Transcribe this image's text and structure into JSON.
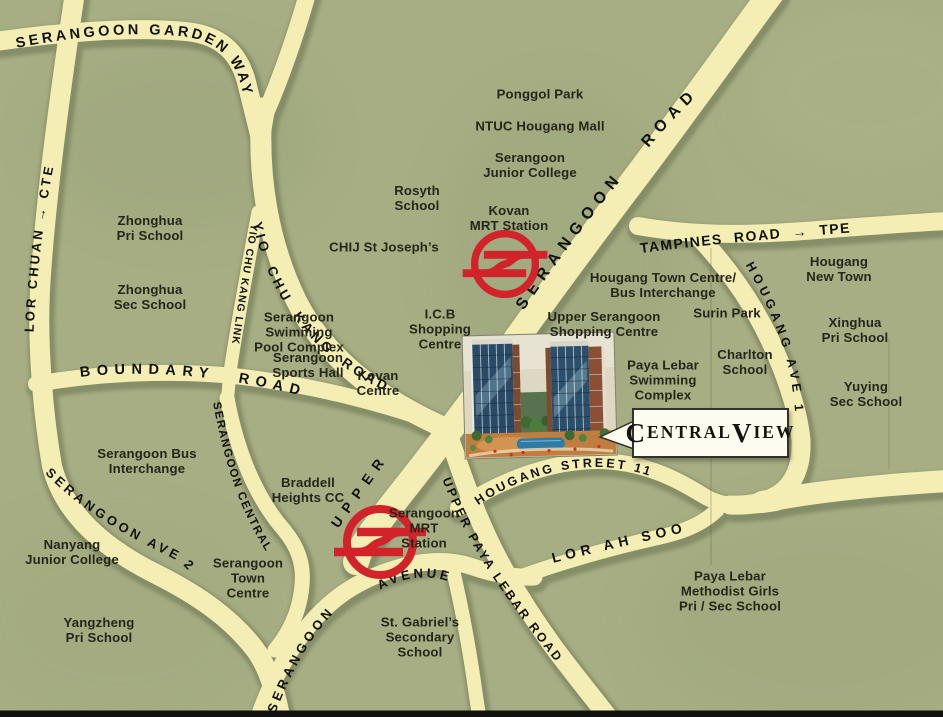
{
  "map": {
    "title": "Central View location map",
    "colors": {
      "background_green": "#a7ae84",
      "road_fill": "#f4eeb5",
      "road_shadow": "#6b7551",
      "label_text": "#26261a",
      "mrt_red": "#d2232b",
      "callout_background": "#fcfcf0",
      "callout_border": "#32322a"
    },
    "callout": {
      "label": "Central View",
      "parts": {
        "c1": "C",
        "r1": "ENTRAL",
        "c2": "V",
        "r2": "IEW"
      }
    },
    "roads": {
      "serangoon_garden_way": "SERANGOON GARDEN WAY",
      "lor_chuan": "LOR CHUAN → CTE",
      "yio_chu_kang_road": "YIO CHU KANG ROAD",
      "yio_chu_kang_link": "YIO CHU KANG LINK",
      "boundary_road": "BOUNDARY ROAD",
      "serangoon_road": "SERANGOON ROAD",
      "upper": "UPPER",
      "tampines_road": "TAMPINES ROAD → TPE",
      "hougang_ave_1": "HOUGANG AVE 1",
      "hougang_street_11": "HOUGANG STREET 11",
      "lor_ah_soo": "LOR AH SOO",
      "upper_paya_lebar_road": "UPPER PAYA LEBAR ROAD",
      "serangoon_central": "SERANGOON CENTRAL",
      "serangoon_ave_2": "SERANGOON AVE 2",
      "serangoon_avenue_a": "SERANGOON",
      "serangoon_avenue_b": "AVENUE"
    },
    "places": {
      "ponggol_park": "Ponggol Park",
      "ntuc_hougang_mall": "NTUC Hougang Mall",
      "serangoon_junior_college": "Serangoon\nJunior College",
      "rosyth_school": "Rosyth\nSchool",
      "kovan_mrt_station": "Kovan\nMRT Station",
      "chij_st_josephs": "CHIJ St Joseph’s",
      "zhonghua_pri_school": "Zhonghua\nPri School",
      "zhonghua_sec_school": "Zhonghua\nSec School",
      "hougang_town_centre": "Hougang Town Centre/\nBus Interchange",
      "hougang_new_town": "Hougang\nNew Town",
      "surin_park": "Surin Park",
      "xinghua_pri_school": "Xinghua\nPri School",
      "upper_serangoon_shopping_centre": "Upper Serangoon\nShopping Centre",
      "icb_shopping_centre": "I.C.B\nShopping\nCentre",
      "serangoon_swimming_pool": "Serangoon\nSwimming\nPool Complex",
      "serangoon_sports_hall": "Serangoon\nSports Hall",
      "kovan_centre": "Kovan\nCentre",
      "paya_lebar_swimming": "Paya Lebar\nSwimming\nComplex",
      "charlton_school": "Charlton\nSchool",
      "yuying_sec_school": "Yuying\nSec School",
      "serangoon_bus_interchange": "Serangoon Bus\nInterchange",
      "braddell_heights_cc": "Braddell\nHeights CC",
      "nanyang_junior_college": "Nanyang\nJunior College",
      "serangoon_town_centre": "Serangoon\nTown\nCentre",
      "yangzheng_pri_school": "Yangzheng\nPri School",
      "st_gabriels": "St. Gabriel’s\nSecondary\nSchool",
      "paya_lebar_methodist": "Paya Lebar\nMethodist Girls\nPri / Sec School",
      "serangoon_mrt_station": "Serangoon\nMRT\nStation"
    }
  }
}
